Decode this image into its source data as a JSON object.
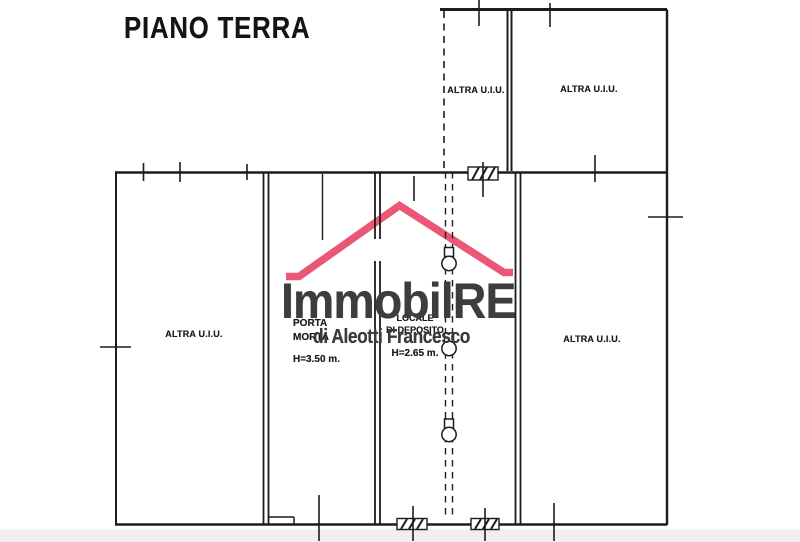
{
  "document": {
    "type": "cadastral floor plan (scanned)",
    "title": "PIANO TERRA"
  },
  "rooms": {
    "top_left_unit": {
      "label": "ALTRA U.I.U."
    },
    "top_right_unit": {
      "label": "ALTRA U.I.U."
    },
    "left_unit": {
      "label": "ALTRA U.I.U."
    },
    "right_unit": {
      "label": "ALTRA U.I.U."
    },
    "porta_morta": {
      "name_line1": "PORTA",
      "name_line2": "MORTA",
      "height": "H=3.50 m."
    },
    "deposito": {
      "name_line1": "LOCALE",
      "name_line2": "DI DEPOSITO",
      "height": "H=2.65 m."
    }
  },
  "watermark": {
    "brand": "ImmobilRE",
    "tagline": "di Aleotti Francesco",
    "roof_color": "#e8496b",
    "text_color": "#3d3d3d"
  },
  "colors": {
    "ink": "#1c1c1c",
    "paper": "#ffffff",
    "scan_strip": "#ebebeb"
  }
}
